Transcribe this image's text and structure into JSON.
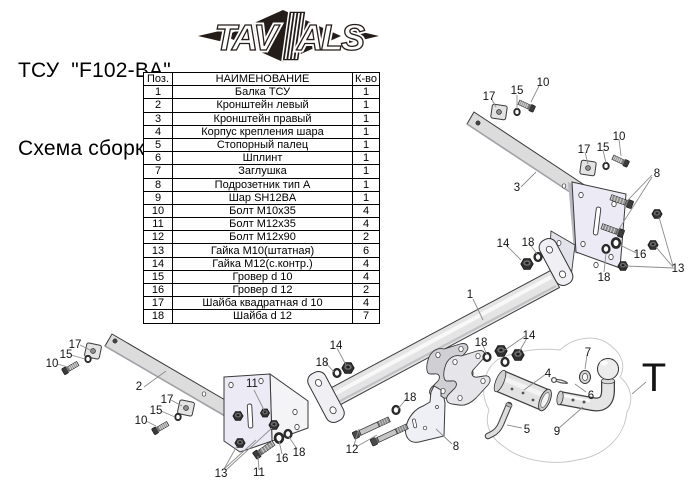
{
  "title": {
    "line1": "ТСУ  \"F102-BA\"",
    "line2": "Схема сборки"
  },
  "logo": {
    "left": "TAV",
    "right": "ALS"
  },
  "table": {
    "headers": [
      "Поз.",
      "НАИМЕНОВАНИЕ",
      "К-во"
    ],
    "rows": [
      [
        "1",
        "Балка ТСУ",
        "1"
      ],
      [
        "2",
        "Кронштейн левый",
        "1"
      ],
      [
        "3",
        "Кронштейн правый",
        "1"
      ],
      [
        "4",
        "Корпус крепления шара",
        "1"
      ],
      [
        "5",
        "Стопорный палец",
        "1"
      ],
      [
        "6",
        "Шплинт",
        "1"
      ],
      [
        "7",
        "Заглушка",
        "1"
      ],
      [
        "8",
        "Подрозетник тип А",
        "1"
      ],
      [
        "9",
        "Шар SH12BA",
        "1"
      ],
      [
        "10",
        "Болт М10х35",
        "4"
      ],
      [
        "11",
        "Болт М12х35",
        "4"
      ],
      [
        "12",
        "Болт М12х90",
        "2"
      ],
      [
        "13",
        "Гайка М10(штатная)",
        "6"
      ],
      [
        "14",
        "Гайка М12(с.контр.)",
        "4"
      ],
      [
        "15",
        "Гровер d 10",
        "4"
      ],
      [
        "16",
        "Гровер d 12",
        "2"
      ],
      [
        "17",
        "Шайба квадратная d 10",
        "4"
      ],
      [
        "18",
        "Шайба d 12",
        "7"
      ]
    ]
  },
  "colors": {
    "logo_dark": "#241c18",
    "part_fill": "#dcdcdc",
    "plate_fill": "#eceaf4",
    "outline": "#3a3a3a",
    "leader": "#8c8c8c"
  },
  "diagram": {
    "callouts": [
      {
        "t": "17",
        "x": 75,
        "y": 348
      },
      {
        "t": "15",
        "x": 66,
        "y": 358
      },
      {
        "t": "10",
        "x": 52,
        "y": 367
      },
      {
        "t": "17",
        "x": 167,
        "y": 403
      },
      {
        "t": "15",
        "x": 156,
        "y": 414
      },
      {
        "t": "10",
        "x": 141,
        "y": 424
      },
      {
        "t": "2",
        "x": 139,
        "y": 390
      },
      {
        "t": "11",
        "x": 252,
        "y": 387
      },
      {
        "t": "11",
        "x": 259,
        "y": 476
      },
      {
        "t": "13",
        "x": 221,
        "y": 477
      },
      {
        "t": "16",
        "x": 282,
        "y": 462
      },
      {
        "t": "18",
        "x": 299,
        "y": 456
      },
      {
        "t": "18",
        "x": 322,
        "y": 366
      },
      {
        "t": "14",
        "x": 336,
        "y": 349
      },
      {
        "t": "12",
        "x": 352,
        "y": 453
      },
      {
        "t": "18",
        "x": 410,
        "y": 401
      },
      {
        "t": "8",
        "x": 456,
        "y": 450
      },
      {
        "t": "1",
        "x": 470,
        "y": 298
      },
      {
        "t": "18",
        "x": 481,
        "y": 346
      },
      {
        "t": "14",
        "x": 529,
        "y": 339
      },
      {
        "t": "17",
        "x": 489,
        "y": 100
      },
      {
        "t": "15",
        "x": 517,
        "y": 94
      },
      {
        "t": "10",
        "x": 543,
        "y": 86
      },
      {
        "t": "17",
        "x": 584,
        "y": 153
      },
      {
        "t": "15",
        "x": 603,
        "y": 151
      },
      {
        "t": "10",
        "x": 619,
        "y": 140
      },
      {
        "t": "3",
        "x": 517,
        "y": 191
      },
      {
        "t": "8",
        "x": 657,
        "y": 177
      },
      {
        "t": "16",
        "x": 640,
        "y": 258
      },
      {
        "t": "13",
        "x": 678,
        "y": 272
      },
      {
        "t": "18",
        "x": 604,
        "y": 281
      },
      {
        "t": "14",
        "x": 503,
        "y": 247
      },
      {
        "t": "18",
        "x": 528,
        "y": 246
      },
      {
        "t": "4",
        "x": 548,
        "y": 377
      },
      {
        "t": "5",
        "x": 527,
        "y": 433
      },
      {
        "t": "6",
        "x": 591,
        "y": 399
      },
      {
        "t": "7",
        "x": 588,
        "y": 356
      },
      {
        "t": "9",
        "x": 557,
        "y": 435
      },
      {
        "t": "T",
        "x": 654,
        "y": 391,
        "big": true
      }
    ]
  }
}
